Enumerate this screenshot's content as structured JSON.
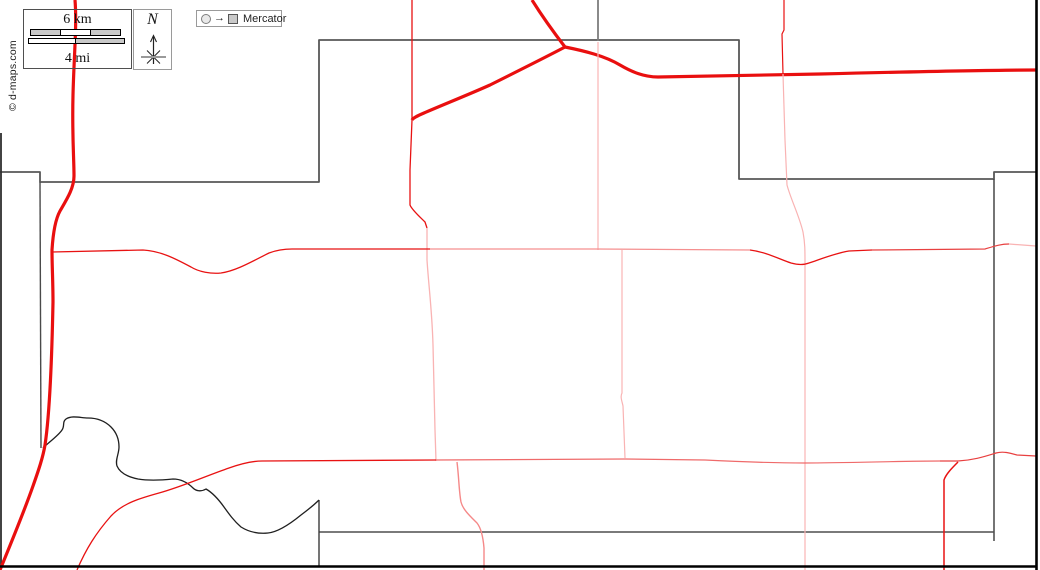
{
  "attribution": {
    "copyright": "© d-maps.com"
  },
  "legend": {
    "scale": {
      "km_label": "6 km",
      "mi_label": "4 mi"
    },
    "compass": {
      "north_label": "N"
    },
    "projection": {
      "arrow_glyph": "→",
      "label": "Mercator"
    }
  },
  "colors": {
    "road_major": "#e90f0f",
    "road_minor": "#e81212",
    "road_faint": "#f9b3b3",
    "road_medium": "#ef6a6a",
    "boundary": "#4f4f4f",
    "border": "#000000",
    "background": "#ffffff"
  },
  "map": {
    "layers": [
      {
        "name": "boundaries",
        "paths": [
          {
            "name": "boundary-county-outline",
            "d": "M 0,172 L 40,172 L 40,182 L 319,182 L 319,40 L 739,40 L 739,179 L 994,179 L 994,172 L 1036,172",
            "stroke": "#585858",
            "width": 1.8
          },
          {
            "name": "boundary-west-vertical",
            "d": "M 40,182 L 41,448",
            "stroke": "#4a4a4a",
            "width": 1.4
          },
          {
            "name": "boundary-left-edge",
            "d": "M 1,133 L 1,567",
            "stroke": "#2e2e2e",
            "width": 1.8
          },
          {
            "name": "boundary-north-stub",
            "d": "M 598,0 L 598,41",
            "stroke": "#7d7d7d",
            "width": 1.8
          },
          {
            "name": "boundary-east-vertical",
            "d": "M 994,179 L 994,541",
            "stroke": "#3a3a3a",
            "width": 1.4
          },
          {
            "name": "boundary-south-horizontal",
            "d": "M 319,532 L 994,532",
            "stroke": "#4f4f4f",
            "width": 1.6
          },
          {
            "name": "boundary-south-vertical",
            "d": "M 319,500 L 319,567",
            "stroke": "#3a3a3a",
            "width": 1.4
          }
        ]
      },
      {
        "name": "water",
        "paths": [
          {
            "name": "river",
            "d": "M 43,448 C 49,442 58,436 62,430 C 65,426 62,422 66,419 C 72,415 81,418 88,418 C 97,418 105,421 111,427 C 117,433 119,440 119,447 C 119,454 115,460 117,466 C 120,473 128,477 138,479 C 150,481 163,480 173,479 C 181,479 188,483 193,488 C 196,491 201,492 206,489 C 213,493 219,500 224,507 C 229,514 234,521 241,527 C 249,532 258,534 268,533 C 278,532 290,524 301,515 C 309,509 316,503 319,500",
            "stroke": "#1f1f1f",
            "width": 1.3
          }
        ]
      },
      {
        "name": "roads",
        "paths": [
          {
            "name": "road-major-west",
            "d": "M 75,0 C 77,25 74,55 73,95 C 72,135 74,158 74,176 C 74,188 67,199 60,211 C 55,220 53,234 52,250 C 52,266 53,282 53,302 C 52,352 50,412 45,445 C 43,457 39,469 33,486 C 26,506 14,536 0,570",
            "stroke": "#e90f0f",
            "width": 3.2
          },
          {
            "name": "road-major-north",
            "d": "M 532,0 C 542,16 555,34 565,47",
            "stroke": "#e90f0f",
            "width": 3.2
          },
          {
            "name": "road-major-diagonal",
            "d": "M 565,47 C 548,56 520,70 490,85 C 470,94 440,106 424,113 C 417,116 413,118 412,120",
            "stroke": "#e90f0f",
            "width": 3.2
          },
          {
            "name": "road-major-east",
            "d": "M 565,47 C 585,51 605,56 620,65 C 632,72 644,77 658,77 C 700,76 760,75 820,74 C 900,72 980,70 1036,70",
            "stroke": "#e90f0f",
            "width": 3.2
          },
          {
            "name": "road-minor-vertical-north",
            "d": "M 412,0 L 412,120 L 410,170 L 410,205 C 412,210 420,217 425,222 L 427,228",
            "stroke": "#e81212",
            "width": 1.3
          },
          {
            "name": "road-faint-vertical-center",
            "d": "M 427,228 L 427,260 C 429,290 432,310 433,345 L 435,430 L 436,461",
            "stroke": "#f9b3b3",
            "width": 1.3
          },
          {
            "name": "road-minor-vertical-ne",
            "d": "M 784,0 L 784,30 L 782,34 L 783,74",
            "stroke": "#e81212",
            "width": 1.2
          },
          {
            "name": "road-faint-vertical-ne",
            "d": "M 783,74 L 785,140 L 787,185 C 791,200 799,215 803,232 C 805,243 805,250 805,263 L 805,570",
            "stroke": "#f9b3b3",
            "width": 1.2
          },
          {
            "name": "road-faint-vertical-mid",
            "d": "M 598,42 L 598,250",
            "stroke": "#f9b3b3",
            "width": 1.2
          },
          {
            "name": "road-faint-vertical-south",
            "d": "M 622,250 L 622,393 C 620,397 622,401 623,406 L 625,458",
            "stroke": "#f9b3b3",
            "width": 1.2
          },
          {
            "name": "road-minor-horizontal-west",
            "d": "M 52,252 L 143,250 C 161,251 176,259 191,267 C 199,272 211,274 221,273 C 236,271 253,261 269,253 C 277,250 284,249 292,249 L 430,249",
            "stroke": "#e81212",
            "width": 1.3
          },
          {
            "name": "road-medium-horizontal-mid",
            "d": "M 430,249 L 595,249 L 750,250",
            "stroke": "#f58f8f",
            "width": 1.2
          },
          {
            "name": "road-minor-horizontal-dip",
            "d": "M 750,250 C 766,252 779,259 791,263 C 798,265 804,265 809,263 C 821,259 836,253 849,251 L 872,250",
            "stroke": "#e81212",
            "width": 1.3
          },
          {
            "name": "road-minor-horizontal-east",
            "d": "M 872,250 L 985,249 C 995,246 1001,244 1009,244",
            "stroke": "#e84040",
            "width": 1.2
          },
          {
            "name": "road-faint-horizontal-east-end",
            "d": "M 1009,244 L 1036,246",
            "stroke": "#f9b3b3",
            "width": 1.2
          },
          {
            "name": "road-minor-sw-diagonal",
            "d": "M 77,570 C 86,549 96,533 111,516 C 123,503 141,498 159,493 C 181,487 206,476 229,468 C 243,463 254,461 262,461 L 436,460",
            "stroke": "#e81212",
            "width": 1.3
          },
          {
            "name": "road-medium-horizontal-south",
            "d": "M 436,460 L 625,459 L 705,460 C 745,462 775,463 805,463 C 845,463 905,461 940,461",
            "stroke": "#ef6a6a",
            "width": 1.2
          },
          {
            "name": "road-minor-horizontal-south-east",
            "d": "M 940,461 L 958,461 C 975,460 986,456 996,453 C 1003,451 1010,453 1017,455 L 1036,456",
            "stroke": "#e84040",
            "width": 1.2
          },
          {
            "name": "road-light-s-curve",
            "d": "M 457,462 C 459,478 459,492 461,502 C 463,510 471,517 477,523 C 481,528 483,536 484,548 L 484,570",
            "stroke": "#f58888",
            "width": 1.4
          },
          {
            "name": "road-minor-vertical-se",
            "d": "M 958,462 C 952,468 946,474 944,480 L 944,570",
            "stroke": "#e81212",
            "width": 1.5
          }
        ]
      },
      {
        "name": "borders",
        "paths": [
          {
            "name": "map-border-right",
            "d": "M 1036.5,0 L 1036.5,570",
            "stroke": "#000000",
            "width": 2.6
          },
          {
            "name": "map-border-bottom",
            "d": "M 0,566.5 L 1037,566.5",
            "stroke": "#000000",
            "width": 2.6
          }
        ]
      }
    ]
  }
}
